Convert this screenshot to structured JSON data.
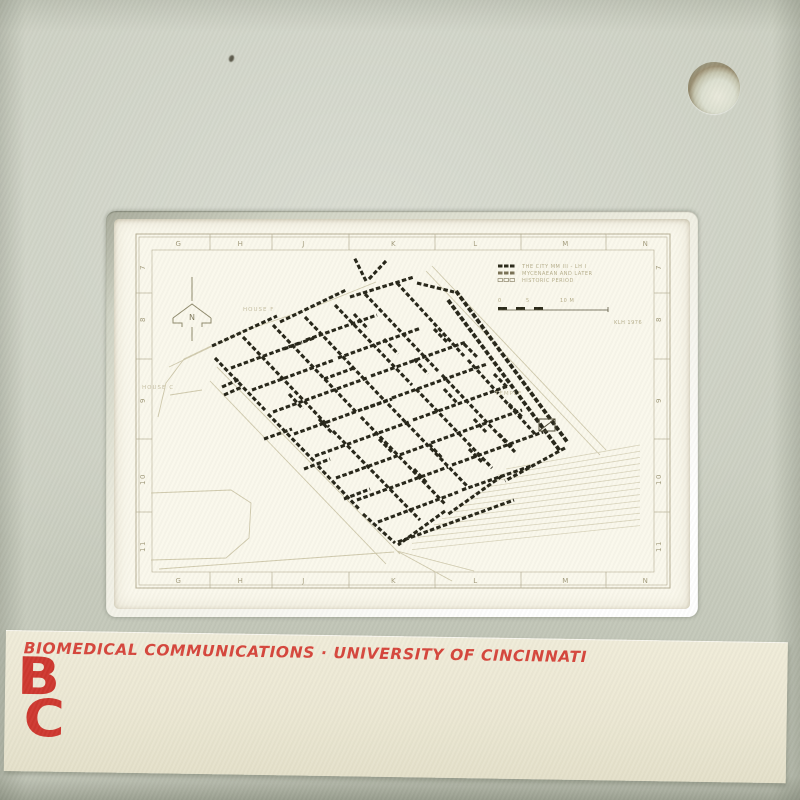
{
  "label_strip": {
    "title": "BIOMEDICAL COMMUNICATIONS · UNIVERSITY OF CINCINNATI",
    "logo": {
      "top": "B",
      "bottom": "C"
    }
  },
  "map": {
    "grid_letters": [
      "G",
      "H",
      "J",
      "K",
      "L",
      "M",
      "N"
    ],
    "grid_numbers": [
      "7",
      "8",
      "9",
      "10",
      "11"
    ],
    "north_label": "N",
    "legend": {
      "entries": [
        "THE CITY  MM III - LH I",
        "MYCENAEAN AND LATER",
        "HISTORIC PERIOD"
      ],
      "scale_ticks": [
        "0",
        "5",
        "10 M"
      ],
      "credit": "KLH 1976"
    },
    "labels": {
      "house_f": "HOUSE F",
      "house_c": "HOUSE C",
      "temple": "TEMPLE"
    },
    "walls": [
      [
        98,
        127,
        163,
        97
      ],
      [
        166,
        103,
        232,
        71
      ],
      [
        236,
        78,
        300,
        58
      ],
      [
        303,
        64,
        340,
        73
      ],
      [
        342,
        72,
        454,
        224,
        "thick"
      ],
      [
        334,
        81,
        446,
        232,
        "thick"
      ],
      [
        451,
        229,
        391,
        262
      ],
      [
        388,
        257,
        333,
        296
      ],
      [
        331,
        292,
        284,
        326
      ],
      [
        101,
        139,
        151,
        191
      ],
      [
        154,
        195,
        201,
        243
      ],
      [
        204,
        247,
        246,
        291
      ],
      [
        249,
        295,
        281,
        324
      ],
      [
        129,
        118,
        215,
        208
      ],
      [
        219,
        212,
        306,
        301
      ],
      [
        159,
        106,
        243,
        194
      ],
      [
        247,
        198,
        331,
        285
      ],
      [
        191,
        98,
        270,
        181
      ],
      [
        274,
        185,
        353,
        267
      ],
      [
        221,
        86,
        298,
        166
      ],
      [
        302,
        170,
        378,
        249
      ],
      [
        251,
        75,
        324,
        152
      ],
      [
        328,
        156,
        401,
        233
      ],
      [
        283,
        64,
        350,
        137
      ],
      [
        354,
        141,
        421,
        215
      ],
      [
        117,
        149,
        188,
        123
      ],
      [
        192,
        121,
        263,
        96
      ],
      [
        138,
        171,
        220,
        141
      ],
      [
        224,
        139,
        307,
        109
      ],
      [
        159,
        193,
        253,
        159
      ],
      [
        257,
        157,
        352,
        123
      ],
      [
        180,
        215,
        274,
        181
      ],
      [
        278,
        179,
        373,
        145
      ],
      [
        201,
        237,
        295,
        203
      ],
      [
        299,
        201,
        394,
        167
      ],
      [
        222,
        259,
        313,
        226
      ],
      [
        317,
        224,
        408,
        191
      ],
      [
        243,
        281,
        334,
        248
      ],
      [
        338,
        246,
        429,
        213
      ],
      [
        264,
        303,
        344,
        273
      ],
      [
        348,
        271,
        420,
        246
      ],
      [
        284,
        323,
        400,
        281
      ],
      [
        170,
        130,
        200,
        119
      ],
      [
        210,
        160,
        240,
        149
      ],
      [
        250,
        190,
        278,
        180
      ],
      [
        150,
        220,
        178,
        210
      ],
      [
        190,
        250,
        216,
        240
      ],
      [
        230,
        280,
        256,
        270
      ],
      [
        300,
        140,
        314,
        155
      ],
      [
        330,
        170,
        344,
        185
      ],
      [
        360,
        200,
        372,
        213
      ],
      [
        270,
        120,
        284,
        135
      ],
      [
        240,
        95,
        254,
        110
      ],
      [
        315,
        225,
        329,
        240
      ],
      [
        205,
        200,
        219,
        215
      ],
      [
        175,
        175,
        189,
        190
      ],
      [
        395,
        185,
        408,
        198
      ],
      [
        300,
        250,
        313,
        264
      ],
      [
        265,
        220,
        279,
        234
      ],
      [
        355,
        230,
        369,
        244
      ],
      [
        385,
        215,
        399,
        229
      ],
      [
        320,
        110,
        334,
        124
      ],
      [
        350,
        125,
        364,
        139
      ],
      [
        380,
        155,
        394,
        169
      ],
      [
        108,
        168,
        126,
        160
      ],
      [
        110,
        176,
        128,
        168
      ],
      [
        252,
        62,
        240,
        38
      ],
      [
        255,
        60,
        272,
        42
      ]
    ],
    "faint_paths": [
      "318,47 492,231",
      "312,52 486,236",
      "97,127 70,140 52,164 44,198",
      "55,148 130,112 200,88 262,63",
      "37,274 117,271 137,284 135,319 112,339 37,341",
      "103,148 286,335",
      "96,162 272,345",
      "283,332 360,352",
      "283,332 338,362",
      "45,350 280,333",
      "56,176 88,171"
    ]
  },
  "colors": {
    "mount": "#cbcfc1",
    "label_background": "#ebe7d3",
    "label_red": "#d6463c",
    "logo_red": "#ce382f",
    "film": "#faf8ec",
    "wall_ink": "#262518",
    "faint_ink": "#cfc9ac",
    "grid_ink": "#a49d7e"
  }
}
